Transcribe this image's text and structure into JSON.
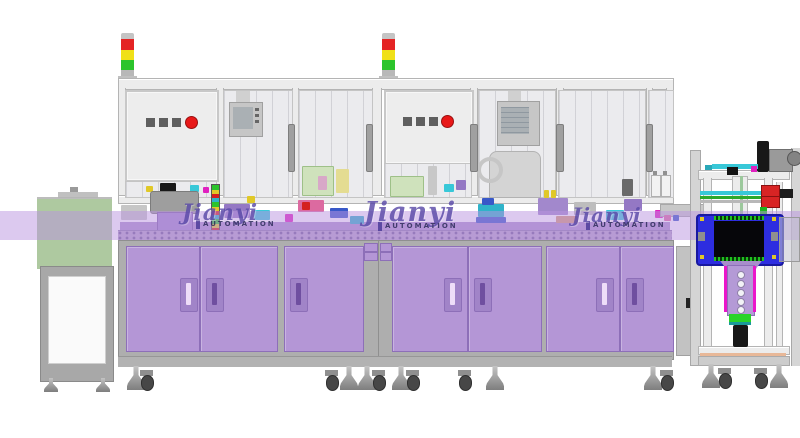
{
  "watermark": {
    "brand": "Jianyi",
    "sub": "AUTOMATION"
  },
  "palette": {
    "band": "rgba(186,148,224,0.5)",
    "cabinet_purple": "#b496d6",
    "cabinet_handle_recess": "#a184c8",
    "handle_slot_light": "#eeddf8",
    "handle_slot_dark": "#6f4fa0",
    "door_border": "#8d6fb8",
    "carcass": "#aeaeae",
    "frame_face": "#ececec",
    "frame_line": "#b4b4b4",
    "panel_face": "#ededed",
    "window_tint": "#ebebee",
    "hmi": "#c6c6c6",
    "hmi_screen": "#aab0b4",
    "btn_dark": "#5f5f5f",
    "btn_red": "#e81818",
    "sl_red": "#e42424",
    "sl_yellow": "#f0e018",
    "sl_green": "#2cc42c",
    "sl_cap": "#c4c4c4",
    "tunnel_green": "#a6c496",
    "stand_grey": "#a8a8a8",
    "white_panel": "#fafafa",
    "table_purple": "#ad93cc",
    "conveyor_purple": "#b4a2c8",
    "bright_green": "#2cc42c",
    "bowl_grey": "#9e9e9e",
    "bowl_base": "#a288cc",
    "teal": "#2fb3c9",
    "cyan": "#38c8d8",
    "blue": "#3858c8",
    "box_blue": "#2d2de0",
    "magenta": "#e020c0",
    "pink": "#dc6aa0",
    "yellow": "#e0c828",
    "salmon": "#d49a78",
    "arm_purple": "#b49ad6",
    "rail_magenta": "#ea16ca",
    "clamp_red": "#d82424",
    "green_part": "#2ca82c",
    "black_part": "#181818",
    "wm_purple": "#5a4aa8",
    "wm_navy": "#2a2a58"
  }
}
